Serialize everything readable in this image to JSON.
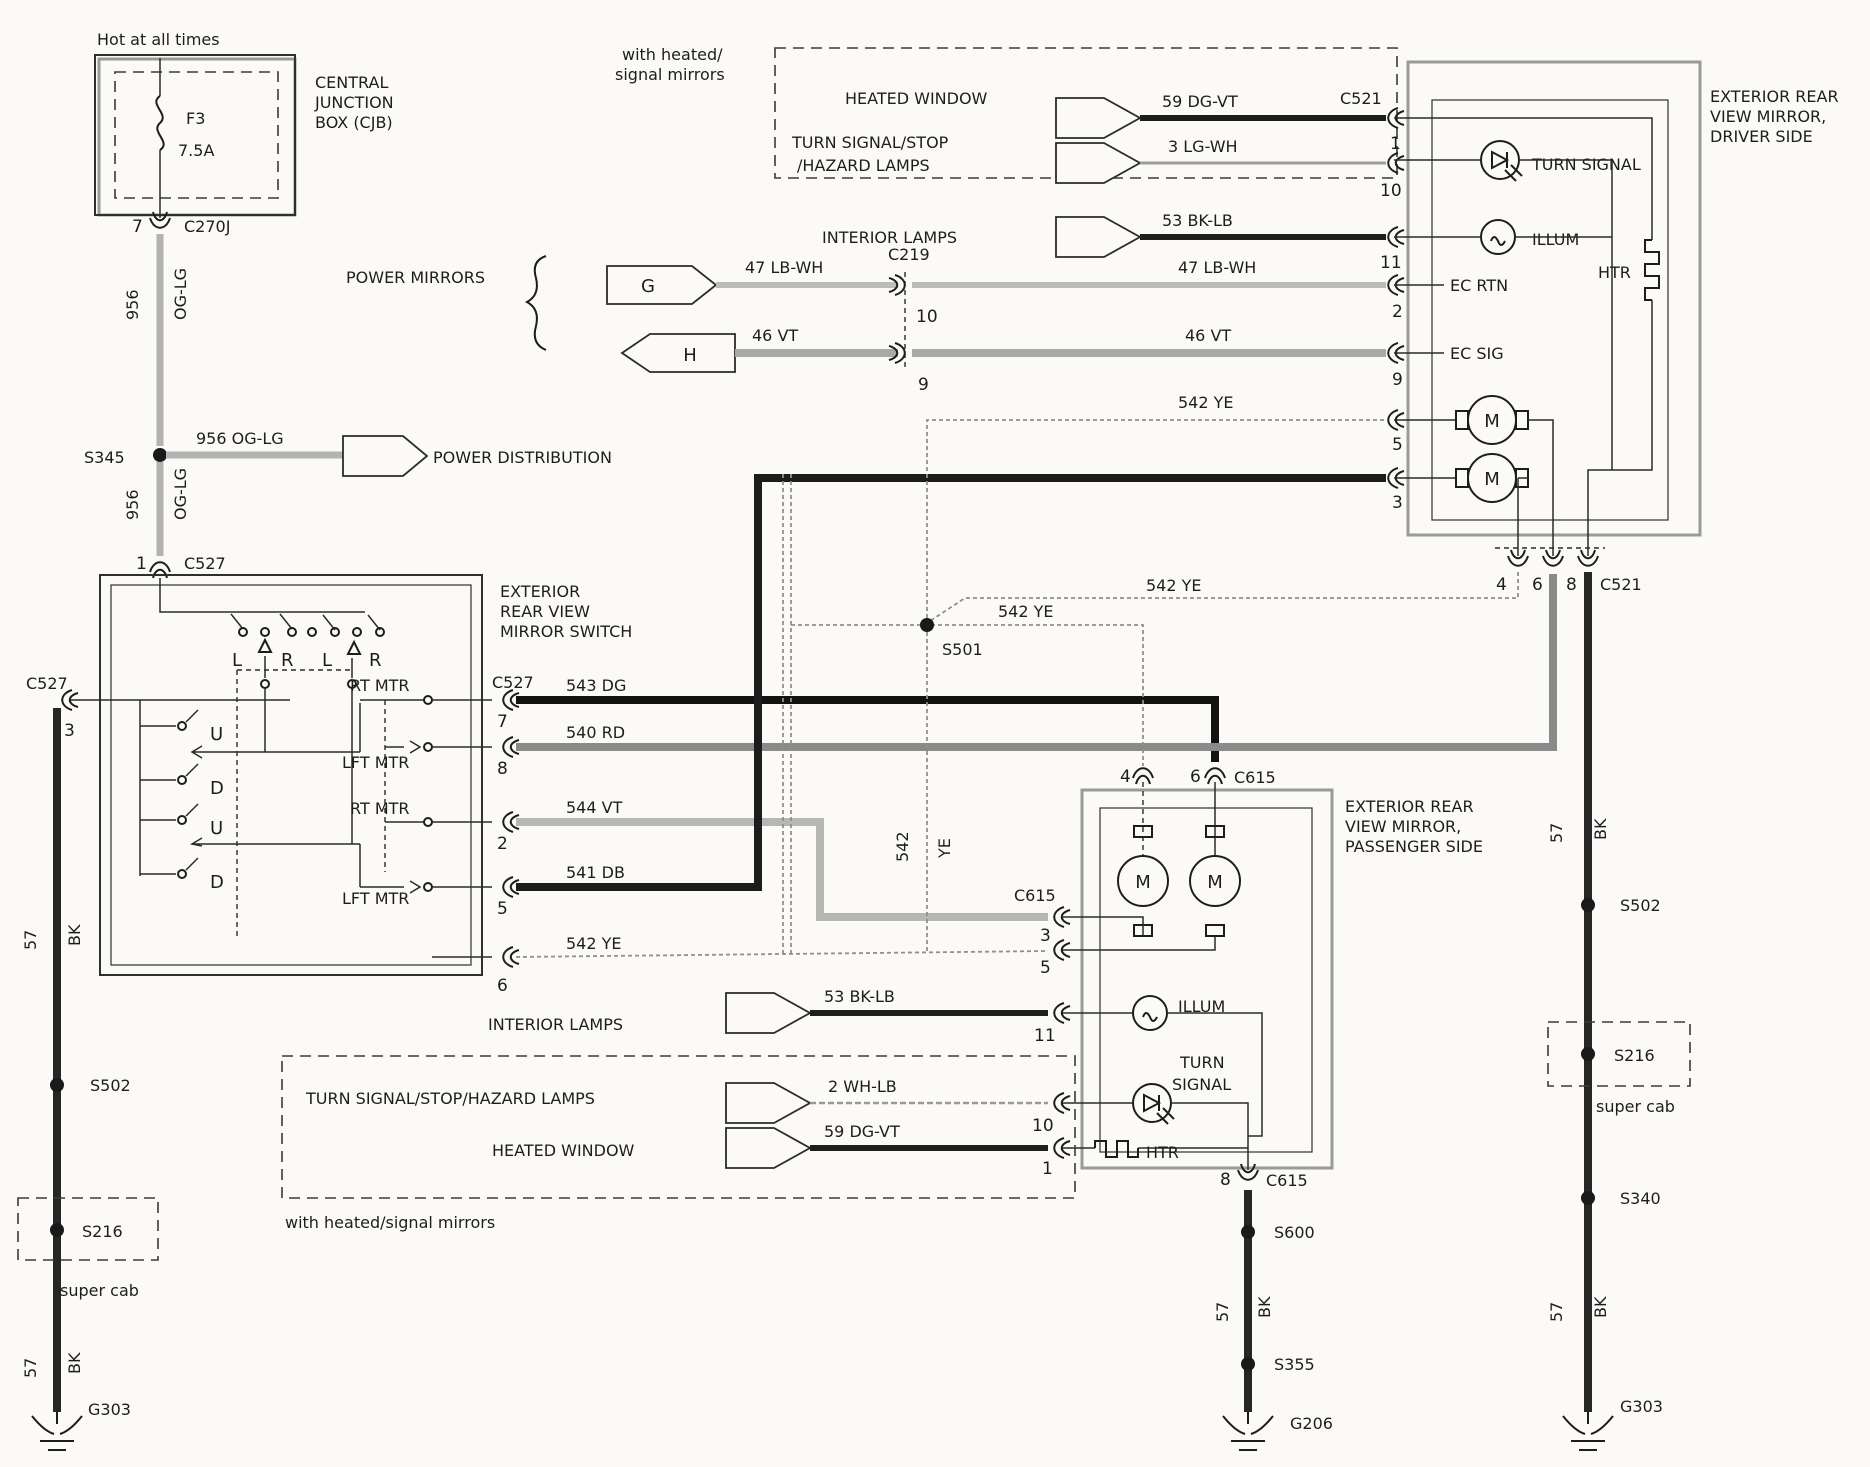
{
  "palette": {
    "paper": "#fbfaf7",
    "ink": "#1d1d1d",
    "wire_dark": "#1c1c1c",
    "wire_gray": "#8a8a8a",
    "wire_light": "#b6b6b6"
  },
  "cjb": {
    "hot": "Hot at all times",
    "name1": "CENTRAL",
    "name2": "JUNCTION",
    "name3": "BOX (CJB)",
    "fuse": "F3",
    "rating": "7.5A",
    "pin": "7",
    "connector": "C270J"
  },
  "feed": {
    "circuit_a": "956",
    "color_a": "OG-LG",
    "label_mid": "956   OG-LG",
    "power_dist": "POWER DISTRIBUTION",
    "circuit_b": "956",
    "color_b": "OG-LG",
    "pin1": "1",
    "c527": "C527"
  },
  "top": {
    "note1": "with heated/",
    "note2": "signal mirrors",
    "heated_window": "HEATED WINDOW",
    "turn1": "TURN SIGNAL/STOP",
    "turn2": "/HAZARD LAMPS",
    "interior": "INTERIOR LAMPS",
    "w59": "59   DG-VT",
    "c521": "C521",
    "p1": "1",
    "w3": "3 LG-WH",
    "p10": "10",
    "w53": "53   BK-LB",
    "p11": "11"
  },
  "mirrors_feed": {
    "power_mirrors": "POWER MIRRORS",
    "g": "G",
    "h": "H",
    "w47l": "47   LB-WH",
    "c219": "C219",
    "p10": "10",
    "w46l": "46   VT",
    "p9": "9",
    "w47r": "47   LB-WH",
    "w46r": "46   VT"
  },
  "driver": {
    "t1": "EXTERIOR REAR",
    "t2": "VIEW MIRROR,",
    "t3": "DRIVER SIDE",
    "turn": "TURN SIGNAL",
    "illum": "ILLUM",
    "htr": "HTR",
    "ecrtn": "EC RTN",
    "p2": "2",
    "ecsig": "EC SIG",
    "p9": "9",
    "w542": "542   YE",
    "p5": "5",
    "p3": "3",
    "m": "M",
    "p4": "4",
    "p6": "6",
    "p8": "8",
    "c521": "C521"
  },
  "switch": {
    "t1": "EXTERIOR",
    "t2": "REAR VIEW",
    "t3": "MIRROR SWITCH",
    "l1": "L",
    "r1": "R",
    "l2": "L",
    "r2": "R",
    "u1": "U",
    "d1": "D",
    "u2": "U",
    "d2": "D",
    "rt1": "RT MTR",
    "lft1": "LFT MTR",
    "rt2": "RT MTR",
    "lft2": "LFT MTR",
    "c527": "C527",
    "w543": "543   DG",
    "p7": "7",
    "w540": "540   RD",
    "p8": "8",
    "w544": "544   VT",
    "p2": "2",
    "w541": "541   DB",
    "p5": "5",
    "w542": "542   YE",
    "p6": "6"
  },
  "left_run": {
    "c527": "C527",
    "p3": "3",
    "c57a": "57",
    "bka": "BK",
    "s502": "S502",
    "s216": "S216",
    "supercab": "super cab",
    "c57b": "57",
    "bkb": "BK",
    "g303": "G303"
  },
  "net542": {
    "a": "542   YE",
    "b": "542   YE",
    "s501": "S501",
    "v1": "542",
    "v2": "YE"
  },
  "passenger": {
    "p4": "4",
    "p6": "6",
    "c615t": "C615",
    "t1": "EXTERIOR REAR",
    "t2": "VIEW MIRROR,",
    "t3": "PASSENGER SIDE",
    "c615l": "C615",
    "p3": "3",
    "p5": "5",
    "m": "M",
    "illum": "ILLUM",
    "p11": "11",
    "turn1": "TURN",
    "turn2": "SIGNAL",
    "p10": "10",
    "htr": "HTR",
    "p1": "1",
    "p8": "8",
    "c615b": "C615"
  },
  "bottom": {
    "interior": "INTERIOR LAMPS",
    "w53": "53   BK-LB",
    "turns": "TURN SIGNAL/STOP/HAZARD LAMPS",
    "w2": "2 WH-LB",
    "heated": "HEATED WINDOW",
    "w59": "59   DG-VT",
    "note": "with heated/signal mirrors"
  },
  "center_run": {
    "s600": "S600",
    "c57": "57",
    "bk": "BK",
    "s355": "S355",
    "g206": "G206"
  },
  "right_run": {
    "c57a": "57",
    "bka": "BK",
    "s502": "S502",
    "s216": "S216",
    "supercab": "super cab",
    "s340": "S340",
    "c57b": "57",
    "bkb": "BK",
    "g303": "G303"
  }
}
